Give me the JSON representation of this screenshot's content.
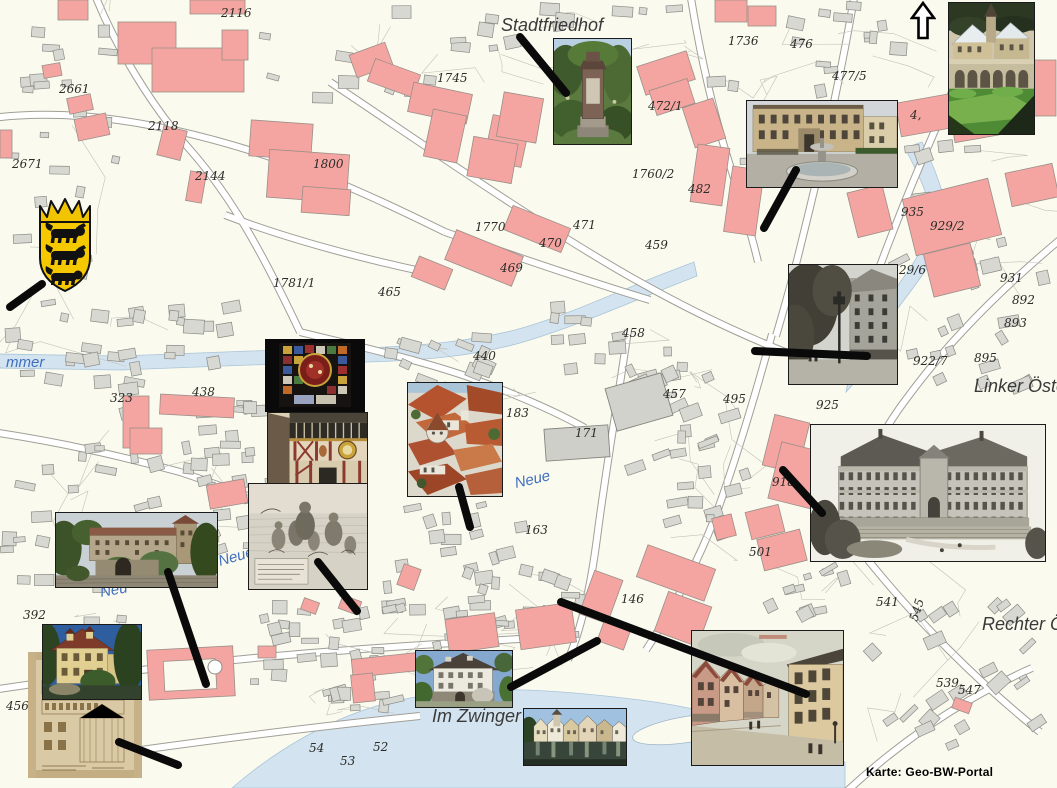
{
  "map": {
    "attribution": "Karte: Geo-BW-Portal",
    "north_arrow_icon": "north-arrow",
    "coat_of_arms_icon": "baden-wuerttemberg-coat-of-arms",
    "place_labels": [
      {
        "text": "Stadtfriedhof",
        "x": 501,
        "y": 31,
        "kind": "place"
      },
      {
        "text": "Im Zwinger",
        "x": 432,
        "y": 722,
        "kind": "place"
      },
      {
        "text": "Linker Öster",
        "x": 974,
        "y": 392,
        "kind": "place"
      },
      {
        "text": "Rechter Ös",
        "x": 982,
        "y": 630,
        "kind": "place"
      },
      {
        "text": "mmer",
        "x": 6,
        "y": 367,
        "kind": "river"
      },
      {
        "text": "Neue",
        "x": 220,
        "y": 566,
        "kind": "river",
        "rotate": -16
      },
      {
        "text": "Neue",
        "x": 516,
        "y": 488,
        "kind": "river",
        "rotate": -13
      },
      {
        "text": "Neu",
        "x": 101,
        "y": 597,
        "kind": "river",
        "rotate": -10
      }
    ],
    "parcel_labels": [
      {
        "text": "2116",
        "x": 221,
        "y": 17
      },
      {
        "text": "2661",
        "x": 59,
        "y": 93
      },
      {
        "text": "2671",
        "x": 12,
        "y": 168
      },
      {
        "text": "2118",
        "x": 148,
        "y": 130
      },
      {
        "text": "2144",
        "x": 195,
        "y": 180
      },
      {
        "text": "1800",
        "x": 313,
        "y": 168
      },
      {
        "text": "1745",
        "x": 437,
        "y": 82
      },
      {
        "text": "1770",
        "x": 475,
        "y": 231
      },
      {
        "text": "1781/1",
        "x": 273,
        "y": 287
      },
      {
        "text": "465",
        "x": 378,
        "y": 296
      },
      {
        "text": "471",
        "x": 573,
        "y": 229
      },
      {
        "text": "470",
        "x": 539,
        "y": 247
      },
      {
        "text": "469",
        "x": 500,
        "y": 272
      },
      {
        "text": "459",
        "x": 645,
        "y": 249
      },
      {
        "text": "458",
        "x": 622,
        "y": 337
      },
      {
        "text": "440",
        "x": 473,
        "y": 360
      },
      {
        "text": "472/1",
        "x": 648,
        "y": 110
      },
      {
        "text": "1736",
        "x": 728,
        "y": 45
      },
      {
        "text": "476",
        "x": 790,
        "y": 48
      },
      {
        "text": "477/5",
        "x": 832,
        "y": 80
      },
      {
        "text": "1760/2",
        "x": 632,
        "y": 178
      },
      {
        "text": "482",
        "x": 688,
        "y": 193
      },
      {
        "text": "438",
        "x": 192,
        "y": 396
      },
      {
        "text": "323",
        "x": 110,
        "y": 402
      },
      {
        "text": "392",
        "x": 23,
        "y": 619
      },
      {
        "text": "4569",
        "x": 6,
        "y": 710
      },
      {
        "text": "183",
        "x": 506,
        "y": 417
      },
      {
        "text": "171",
        "x": 575,
        "y": 437
      },
      {
        "text": "457",
        "x": 663,
        "y": 398
      },
      {
        "text": "495",
        "x": 723,
        "y": 403
      },
      {
        "text": "163",
        "x": 525,
        "y": 534
      },
      {
        "text": "501",
        "x": 749,
        "y": 556
      },
      {
        "text": "146",
        "x": 621,
        "y": 603
      },
      {
        "text": "29/6",
        "x": 899,
        "y": 274
      },
      {
        "text": "935",
        "x": 901,
        "y": 216
      },
      {
        "text": "929/2",
        "x": 930,
        "y": 230
      },
      {
        "text": "931",
        "x": 1000,
        "y": 282
      },
      {
        "text": "892",
        "x": 1012,
        "y": 304
      },
      {
        "text": "893",
        "x": 1004,
        "y": 327
      },
      {
        "text": "895",
        "x": 974,
        "y": 362
      },
      {
        "text": "922/7",
        "x": 913,
        "y": 365
      },
      {
        "text": "925",
        "x": 816,
        "y": 409
      },
      {
        "text": "918",
        "x": 772,
        "y": 486
      },
      {
        "text": "541",
        "x": 876,
        "y": 606
      },
      {
        "text": "545",
        "x": 917,
        "y": 622,
        "rotate": -72
      },
      {
        "text": "539",
        "x": 936,
        "y": 687
      },
      {
        "text": "547",
        "x": 958,
        "y": 694
      },
      {
        "text": "54",
        "x": 309,
        "y": 752
      },
      {
        "text": "52",
        "x": 373,
        "y": 751
      },
      {
        "text": "53",
        "x": 340,
        "y": 765
      },
      {
        "text": "4,",
        "x": 910,
        "y": 119
      }
    ]
  },
  "photos": [
    {
      "name": "stadtfriedhof-monument-photo",
      "x": 553,
      "y": 38,
      "w": 79,
      "h": 107
    },
    {
      "name": "fountain-courtyard-photo",
      "x": 746,
      "y": 100,
      "w": 152,
      "h": 88
    },
    {
      "name": "monastery-winter-photo",
      "x": 948,
      "y": 2,
      "w": 87,
      "h": 133
    },
    {
      "name": "historic-street-bw-photo",
      "x": 788,
      "y": 264,
      "w": 110,
      "h": 121
    },
    {
      "name": "stained-glass-window-photo",
      "x": 265,
      "y": 339,
      "w": 100,
      "h": 73
    },
    {
      "name": "town-hall-facade-photo",
      "x": 267,
      "y": 412,
      "w": 101,
      "h": 78
    },
    {
      "name": "old-town-rooftops-photo",
      "x": 407,
      "y": 382,
      "w": 96,
      "h": 115
    },
    {
      "name": "historic-engraving-photo",
      "x": 248,
      "y": 483,
      "w": 120,
      "h": 107
    },
    {
      "name": "university-building-engraving-photo",
      "x": 810,
      "y": 424,
      "w": 236,
      "h": 138
    },
    {
      "name": "castle-photo",
      "x": 55,
      "y": 512,
      "w": 163,
      "h": 76
    },
    {
      "name": "architectural-plan-photo",
      "x": 28,
      "y": 652,
      "w": 114,
      "h": 126
    },
    {
      "name": "yellow-manor-photo",
      "x": 42,
      "y": 624,
      "w": 100,
      "h": 76
    },
    {
      "name": "zwinger-house-photo",
      "x": 415,
      "y": 650,
      "w": 98,
      "h": 58
    },
    {
      "name": "neckarfront-photo",
      "x": 523,
      "y": 708,
      "w": 104,
      "h": 58
    },
    {
      "name": "postcard-street-photo",
      "x": 691,
      "y": 630,
      "w": 153,
      "h": 136
    }
  ],
  "connector_lines": [
    [
      10,
      307,
      42,
      284
    ],
    [
      520,
      37,
      566,
      93
    ],
    [
      796,
      170,
      764,
      228
    ],
    [
      755,
      351,
      867,
      356
    ],
    [
      783,
      470,
      822,
      513
    ],
    [
      459,
      487,
      470,
      527
    ],
    [
      318,
      562,
      357,
      611
    ],
    [
      561,
      602,
      806,
      694
    ],
    [
      597,
      641,
      511,
      687
    ],
    [
      168,
      572,
      206,
      684
    ],
    [
      119,
      742,
      178,
      765
    ]
  ],
  "colors": {
    "map_background": "#fbfaee",
    "building_pink": "#f4a5a1",
    "building_gray": "#d8d8d3",
    "water_blue": "#d3e4f0",
    "annotation_black": "#0a0a0a",
    "river_label_blue": "#3f6fbe"
  }
}
